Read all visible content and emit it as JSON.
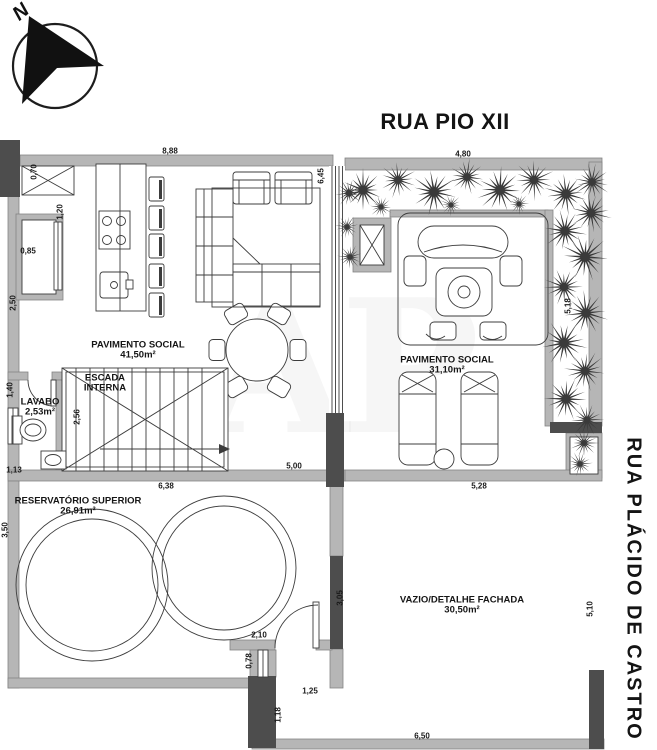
{
  "streets": {
    "top": "RUA PIO XII",
    "right": "RUA PLÁCIDO DE CASTRO"
  },
  "compass": {
    "label": "N"
  },
  "watermark": {
    "text": "AP"
  },
  "colors": {
    "wall_light": "#b6b6b6",
    "wall_dark": "#4d4d4d",
    "line": "#3c3c3c",
    "plant": "#3a3a3a"
  },
  "rooms": [
    {
      "id": "pavimento-social-1",
      "lines": [
        "PAVIMENTO SOCIAL",
        "41,50m²"
      ],
      "x": 138,
      "y": 351
    },
    {
      "id": "escada-interna",
      "lines": [
        "ESCADA",
        "INTERNA"
      ],
      "x": 105,
      "y": 384
    },
    {
      "id": "lavabo",
      "lines": [
        "LAVABO",
        "2,53m²"
      ],
      "x": 40,
      "y": 408
    },
    {
      "id": "pavimento-social-2",
      "lines": [
        "PAVIMENTO SOCIAL",
        "31,10m²"
      ],
      "x": 447,
      "y": 366
    },
    {
      "id": "reservatorio-superior",
      "lines": [
        "RESERVATÓRIO SUPERIOR",
        "26,91m²"
      ],
      "x": 78,
      "y": 507
    },
    {
      "id": "vazio-detalhe-fachada",
      "lines": [
        "VAZIO/DETALHE FACHADA",
        "30,50m²"
      ],
      "x": 462,
      "y": 606
    }
  ],
  "dimensions": [
    {
      "text": "8,88",
      "x": 170,
      "y": 151,
      "rot": 0
    },
    {
      "text": "4,80",
      "x": 463,
      "y": 154,
      "rot": 0
    },
    {
      "text": "0,70",
      "x": 34,
      "y": 172,
      "rot": -90
    },
    {
      "text": "1,20",
      "x": 60,
      "y": 212,
      "rot": -90
    },
    {
      "text": "0,85",
      "x": 28,
      "y": 251,
      "rot": 0
    },
    {
      "text": "2,50",
      "x": 13,
      "y": 303,
      "rot": -90
    },
    {
      "text": "6,45",
      "x": 321,
      "y": 176,
      "rot": -90
    },
    {
      "text": "5,18",
      "x": 568,
      "y": 306,
      "rot": -90
    },
    {
      "text": "1,40",
      "x": 10,
      "y": 390,
      "rot": -90
    },
    {
      "text": "2,56",
      "x": 77,
      "y": 417,
      "rot": -90
    },
    {
      "text": "1,13",
      "x": 14,
      "y": 470,
      "rot": 0
    },
    {
      "text": "5,00",
      "x": 294,
      "y": 466,
      "rot": 0
    },
    {
      "text": "6,38",
      "x": 166,
      "y": 486,
      "rot": 0
    },
    {
      "text": "5,28",
      "x": 479,
      "y": 486,
      "rot": 0
    },
    {
      "text": "3,50",
      "x": 5,
      "y": 530,
      "rot": -90
    },
    {
      "text": "5,10",
      "x": 590,
      "y": 609,
      "rot": -90
    },
    {
      "text": "3,05",
      "x": 340,
      "y": 598,
      "rot": -90
    },
    {
      "text": "2,10",
      "x": 259,
      "y": 635,
      "rot": 0
    },
    {
      "text": "0,78",
      "x": 249,
      "y": 661,
      "rot": -90
    },
    {
      "text": "1,25",
      "x": 310,
      "y": 691,
      "rot": 0
    },
    {
      "text": "1,18",
      "x": 278,
      "y": 715,
      "rot": -90
    },
    {
      "text": "6,50",
      "x": 422,
      "y": 736,
      "rot": 0
    }
  ],
  "plant_icons": [
    {
      "x": 363,
      "y": 190,
      "r": 24
    },
    {
      "x": 398,
      "y": 180,
      "r": 20
    },
    {
      "x": 434,
      "y": 192,
      "r": 26
    },
    {
      "x": 467,
      "y": 177,
      "r": 20
    },
    {
      "x": 500,
      "y": 190,
      "r": 26
    },
    {
      "x": 534,
      "y": 180,
      "r": 22
    },
    {
      "x": 566,
      "y": 194,
      "r": 24
    },
    {
      "x": 592,
      "y": 182,
      "r": 20
    },
    {
      "x": 381,
      "y": 207,
      "r": 13
    },
    {
      "x": 451,
      "y": 205,
      "r": 12
    },
    {
      "x": 519,
      "y": 204,
      "r": 12
    },
    {
      "x": 591,
      "y": 213,
      "r": 22
    },
    {
      "x": 565,
      "y": 231,
      "r": 24
    },
    {
      "x": 585,
      "y": 257,
      "r": 26
    },
    {
      "x": 564,
      "y": 287,
      "r": 22
    },
    {
      "x": 586,
      "y": 313,
      "r": 24
    },
    {
      "x": 564,
      "y": 343,
      "r": 26
    },
    {
      "x": 585,
      "y": 371,
      "r": 22
    },
    {
      "x": 566,
      "y": 399,
      "r": 24
    },
    {
      "x": 587,
      "y": 420,
      "r": 18
    },
    {
      "x": 349,
      "y": 193,
      "r": 16
    },
    {
      "x": 347,
      "y": 227,
      "r": 13
    },
    {
      "x": 350,
      "y": 257,
      "r": 14
    },
    {
      "x": 584,
      "y": 443,
      "r": 16
    },
    {
      "x": 580,
      "y": 464,
      "r": 14
    }
  ]
}
